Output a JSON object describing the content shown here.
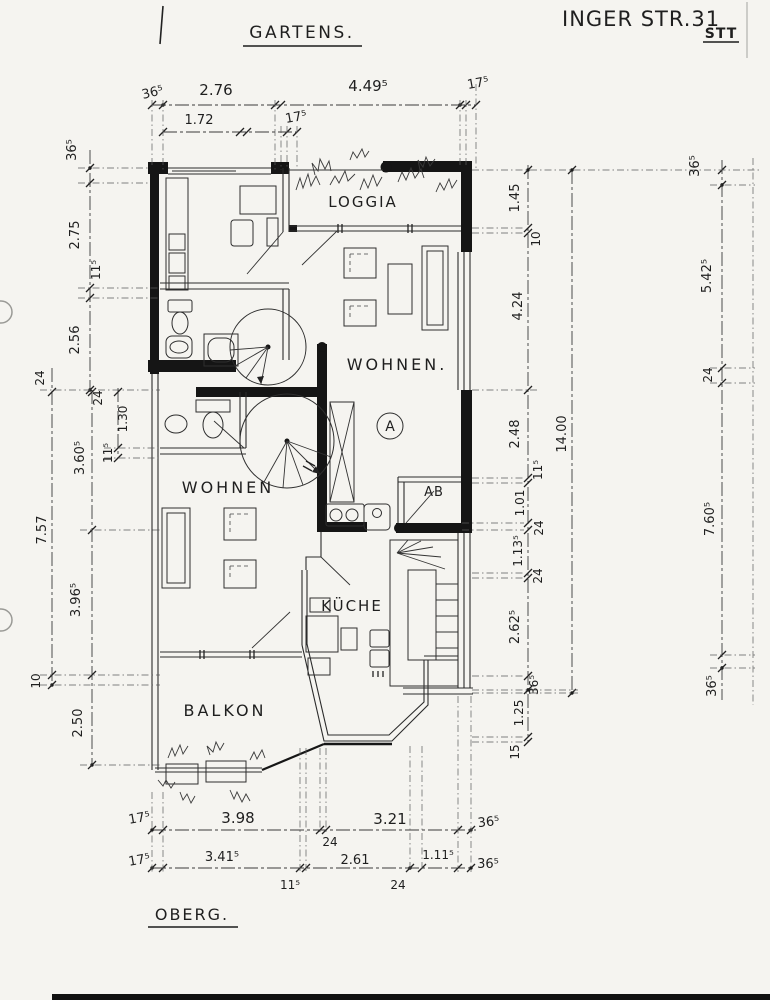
{
  "header": {
    "left": "GARTENS.",
    "right": "INGER STR.31",
    "right_sub": "STT"
  },
  "footer": {
    "label": "OBERG."
  },
  "rooms": {
    "loggia": "LOGGIA",
    "wohnen_a": "WOHNEN.",
    "unit": "A",
    "ab": "AB",
    "wohnen_b": "WOHNEN",
    "kueche": "KÜCHE",
    "balkon": "BALKON"
  },
  "dims": {
    "top1": [
      "36⁵",
      "2.76",
      "4.49⁵",
      "17⁵"
    ],
    "top2": [
      "1.72",
      "17⁵"
    ],
    "left": [
      "36⁵",
      "2.75",
      "11⁵",
      "2.56",
      "24",
      "24",
      "1.30",
      "11⁵",
      "3.60⁵",
      "7.57",
      "3.96⁵",
      "10",
      "2.50"
    ],
    "right": [
      "1.45",
      "10",
      "4.24",
      "2.48",
      "11⁵",
      "1.01",
      "24",
      "1.13⁵",
      "24",
      "2.62⁵",
      "36⁵",
      "1.25",
      "15"
    ],
    "right_total": "14.00",
    "far_right": [
      "36⁵",
      "5.42⁵",
      "24",
      "7.60⁵",
      "36⁵"
    ],
    "bottom1": [
      "17⁵",
      "3.98",
      "24",
      "3.21",
      "36⁵"
    ],
    "bottom2": [
      "17⁵",
      "3.41⁵",
      "11⁵",
      "2.61",
      "24",
      "1.11⁵",
      "36⁵"
    ]
  }
}
